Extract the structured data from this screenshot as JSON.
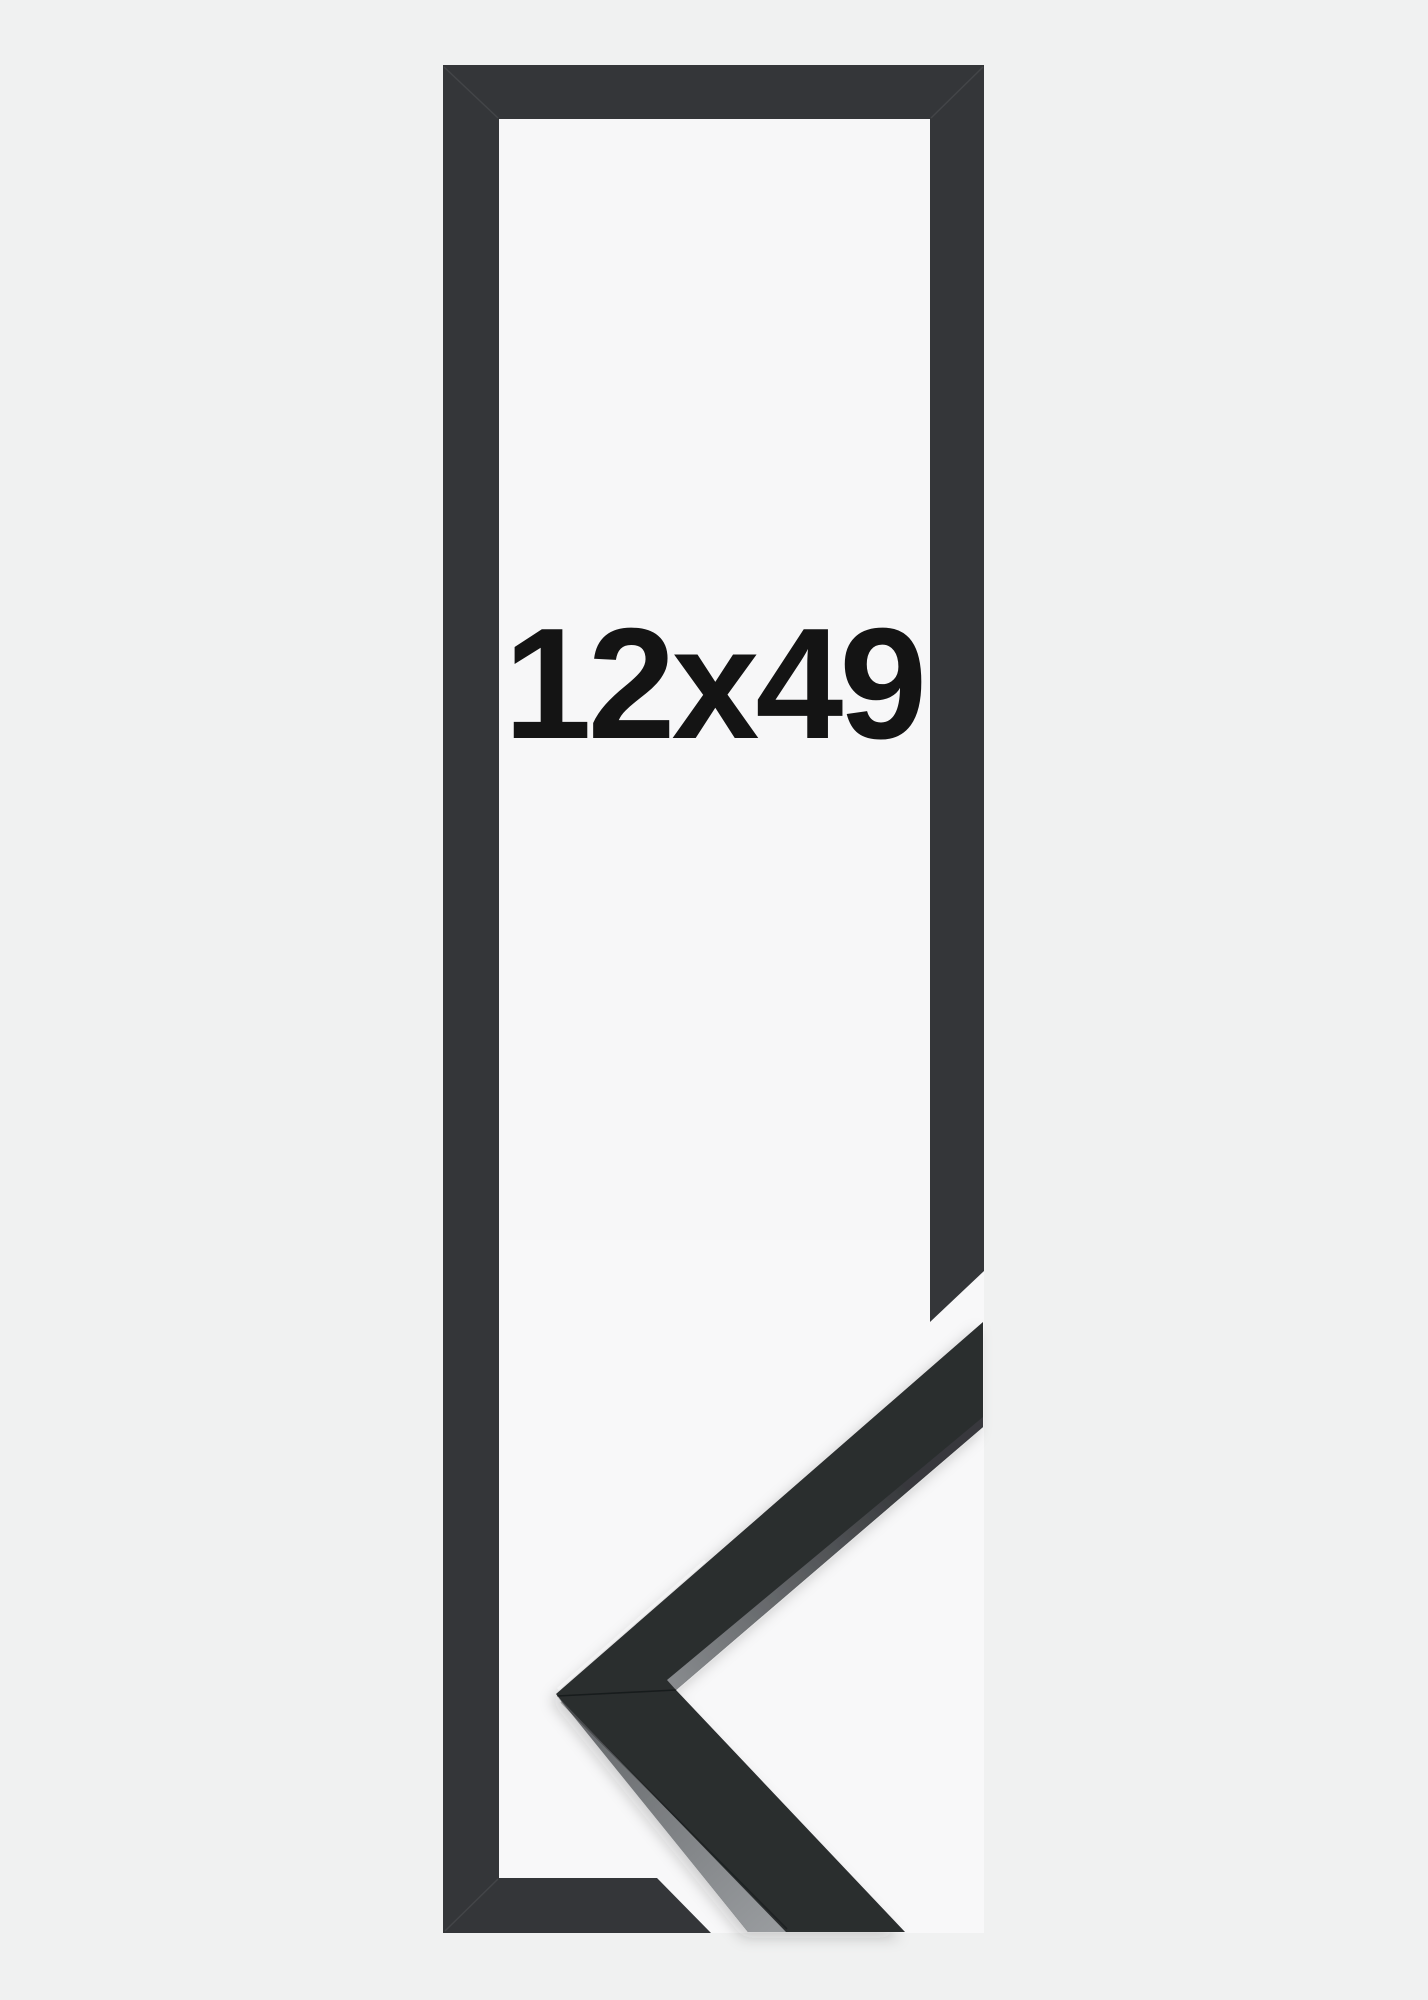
{
  "product": {
    "size_label": "12x49"
  },
  "colors": {
    "bg_outer": "#f0f1f1",
    "bg_interior": "#f7f7f8",
    "bg_photo": "#f8f8f9",
    "frame_flat": "#343639",
    "piece_dark": "#2b2d2f",
    "piece_side_dark": "#37393c",
    "piece_side_light": "#888b8e",
    "band_dark": "#5f6265",
    "band_light": "#989b9e",
    "label_color": "#141414"
  }
}
